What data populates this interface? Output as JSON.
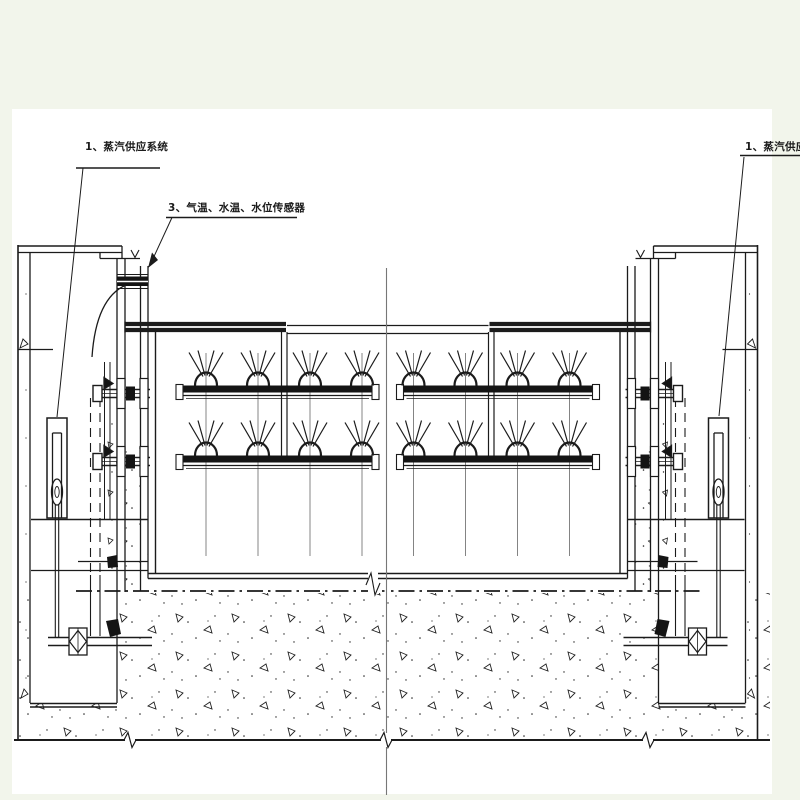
{
  "page": {
    "background_color": "#f2f5eb",
    "paper_color": "#ffffff",
    "ink_color": "#1b1b1b"
  },
  "drawing": {
    "type": "engineering-section-drawing",
    "callouts": {
      "steam_supply_left": "1、蒸汽供应系统",
      "sensors": "3、气温、水温、水位传感器",
      "steam_supply_right": "1、蒸汽供应系统"
    }
  }
}
